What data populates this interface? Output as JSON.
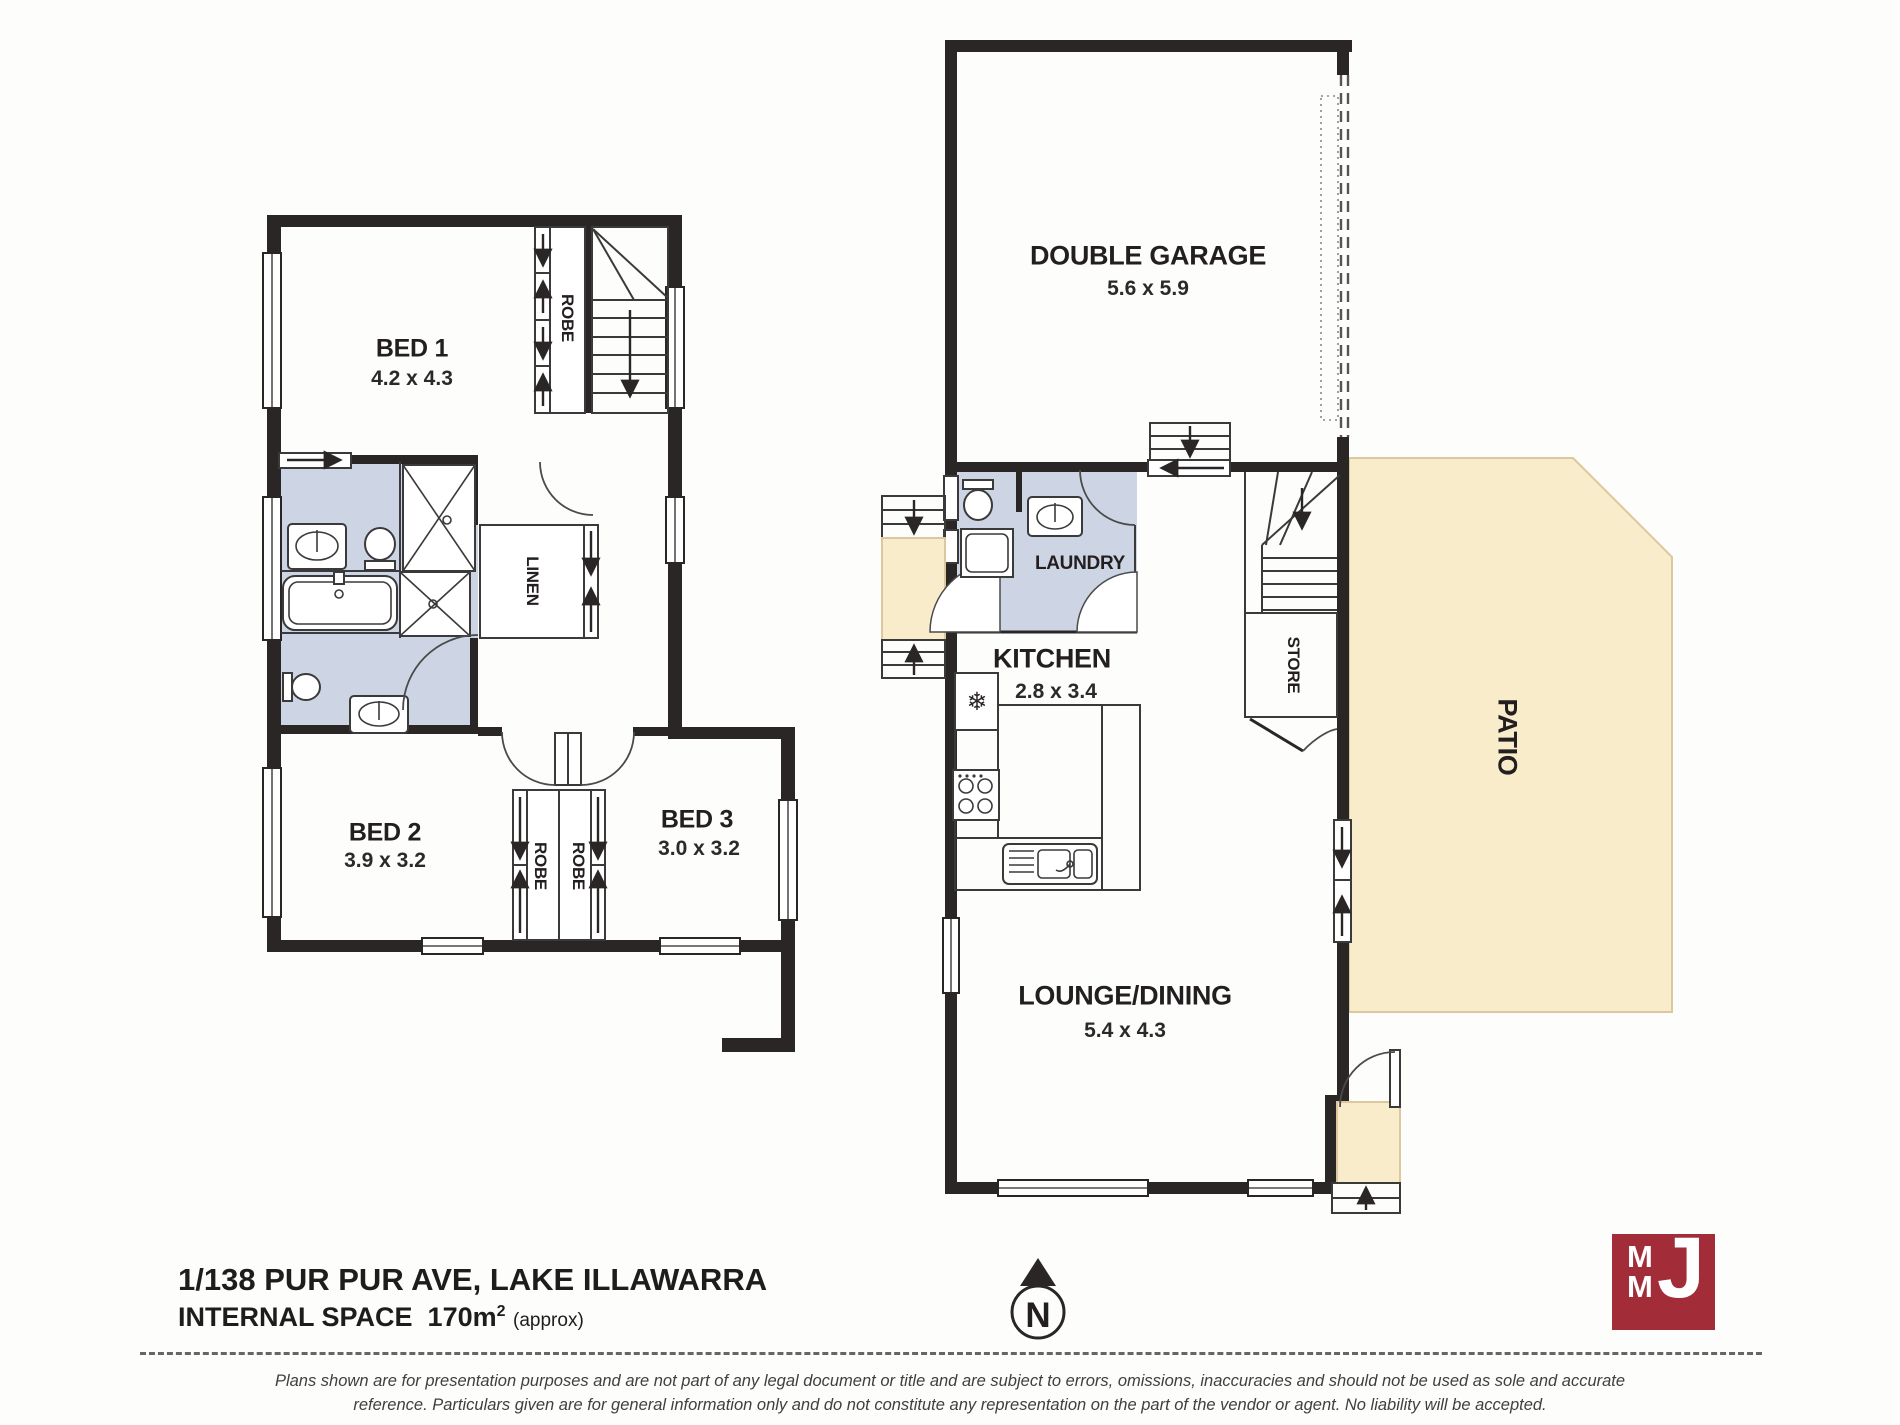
{
  "title_block": {
    "address": "1/138 PUR PUR AVE, LAKE ILLAWARRA",
    "internal_space_label": "INTERNAL SPACE",
    "internal_space_value": "170m",
    "internal_space_sup": "2",
    "internal_space_note": "(approx)"
  },
  "upper_floor": {
    "bed1": {
      "name": "BED 1",
      "dims": "4.2 x 4.3"
    },
    "bed2": {
      "name": "BED 2",
      "dims": "3.9 x 3.2"
    },
    "bed3": {
      "name": "BED 3",
      "dims": "3.0 x 3.2"
    },
    "robe_top": "ROBE",
    "robe_left": "ROBE",
    "robe_right": "ROBE",
    "linen": "LINEN"
  },
  "ground_floor": {
    "garage": {
      "name": "DOUBLE GARAGE",
      "dims": "5.6 x 5.9"
    },
    "laundry": "LAUNDRY",
    "kitchen": {
      "name": "KITCHEN",
      "dims": "2.8 x 3.4"
    },
    "lounge": {
      "name": "LOUNGE/DINING",
      "dims": "5.4 x 4.3"
    },
    "store": "STORE",
    "patio": "PATIO"
  },
  "compass": {
    "north": "N"
  },
  "logo": {
    "m1": "M",
    "m2": "M",
    "j": "J"
  },
  "icons": {
    "fridge_snowflake": "❄"
  },
  "footer": {
    "disclaimer_line1": "Plans shown are for presentation purposes and are not part of any legal document or title and are subject to errors, omissions, inaccuracies and should not be used as sole and accurate",
    "disclaimer_line2": "reference. Particulars given are for general information only and do not constitute any representation on the part of the vendor or agent. No liability will be accepted."
  },
  "colors": {
    "wall": "#2b2626",
    "wet": "#cdd5e4",
    "outdoor": "#f8ecca",
    "logo_red": "#a22c37"
  }
}
